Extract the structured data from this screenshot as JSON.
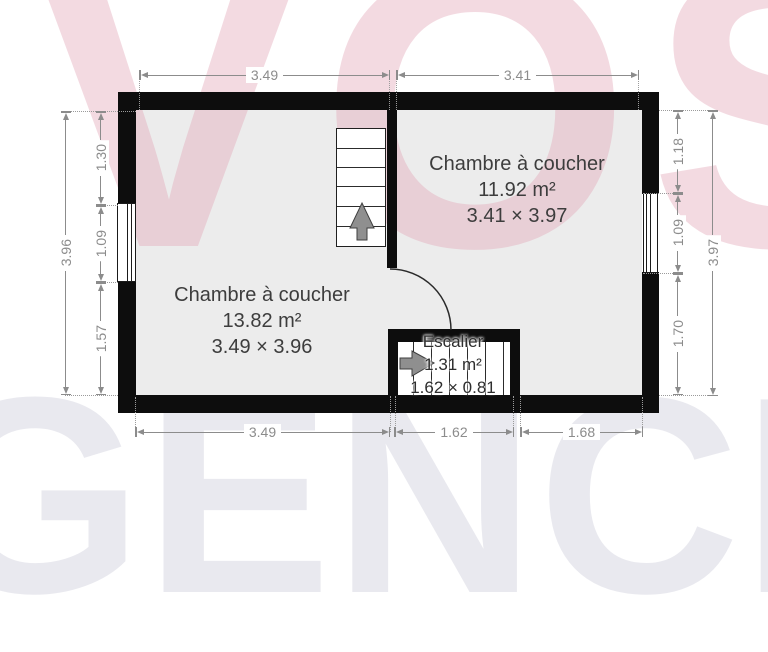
{
  "watermark": {
    "top": "VOS",
    "bottom": "GENCI",
    "top_color": "#f4dfe5",
    "bottom_color": "#ebebef"
  },
  "rooms": {
    "bedroom_left": {
      "name": "Chambre à coucher",
      "area": "13.82 m²",
      "size": "3.49 × 3.96"
    },
    "bedroom_right": {
      "name": "Chambre à coucher",
      "area": "11.92 m²",
      "size": "3.41 × 3.97"
    },
    "staircase": {
      "name": "Escalier",
      "area": "1.31 m²",
      "size": "1.62 × 0.81"
    }
  },
  "dimensions": {
    "top": [
      {
        "label": "3.49"
      },
      {
        "label": "3.41"
      }
    ],
    "bottom": [
      {
        "label": "3.49"
      },
      {
        "label": "1.62"
      },
      {
        "label": "1.68"
      }
    ],
    "left": {
      "outer": {
        "label": "3.96"
      },
      "inner": [
        {
          "label": "1.30"
        },
        {
          "label": "1.09"
        },
        {
          "label": "1.57"
        }
      ]
    },
    "right": {
      "outer": {
        "label": "3.97"
      },
      "inner": [
        {
          "label": "1.18"
        },
        {
          "label": "1.09"
        },
        {
          "label": "1.70"
        }
      ]
    }
  },
  "icons": {
    "stairs_up_arrow": "arrow-up",
    "stairs_right_arrow": "arrow-right",
    "door_swing": "quarter-arc"
  },
  "colors": {
    "wall": "#0d0d0d",
    "floor_fill": "#ececec",
    "dimension_text": "#8c8c8c",
    "room_text": "#3d3d3d"
  }
}
